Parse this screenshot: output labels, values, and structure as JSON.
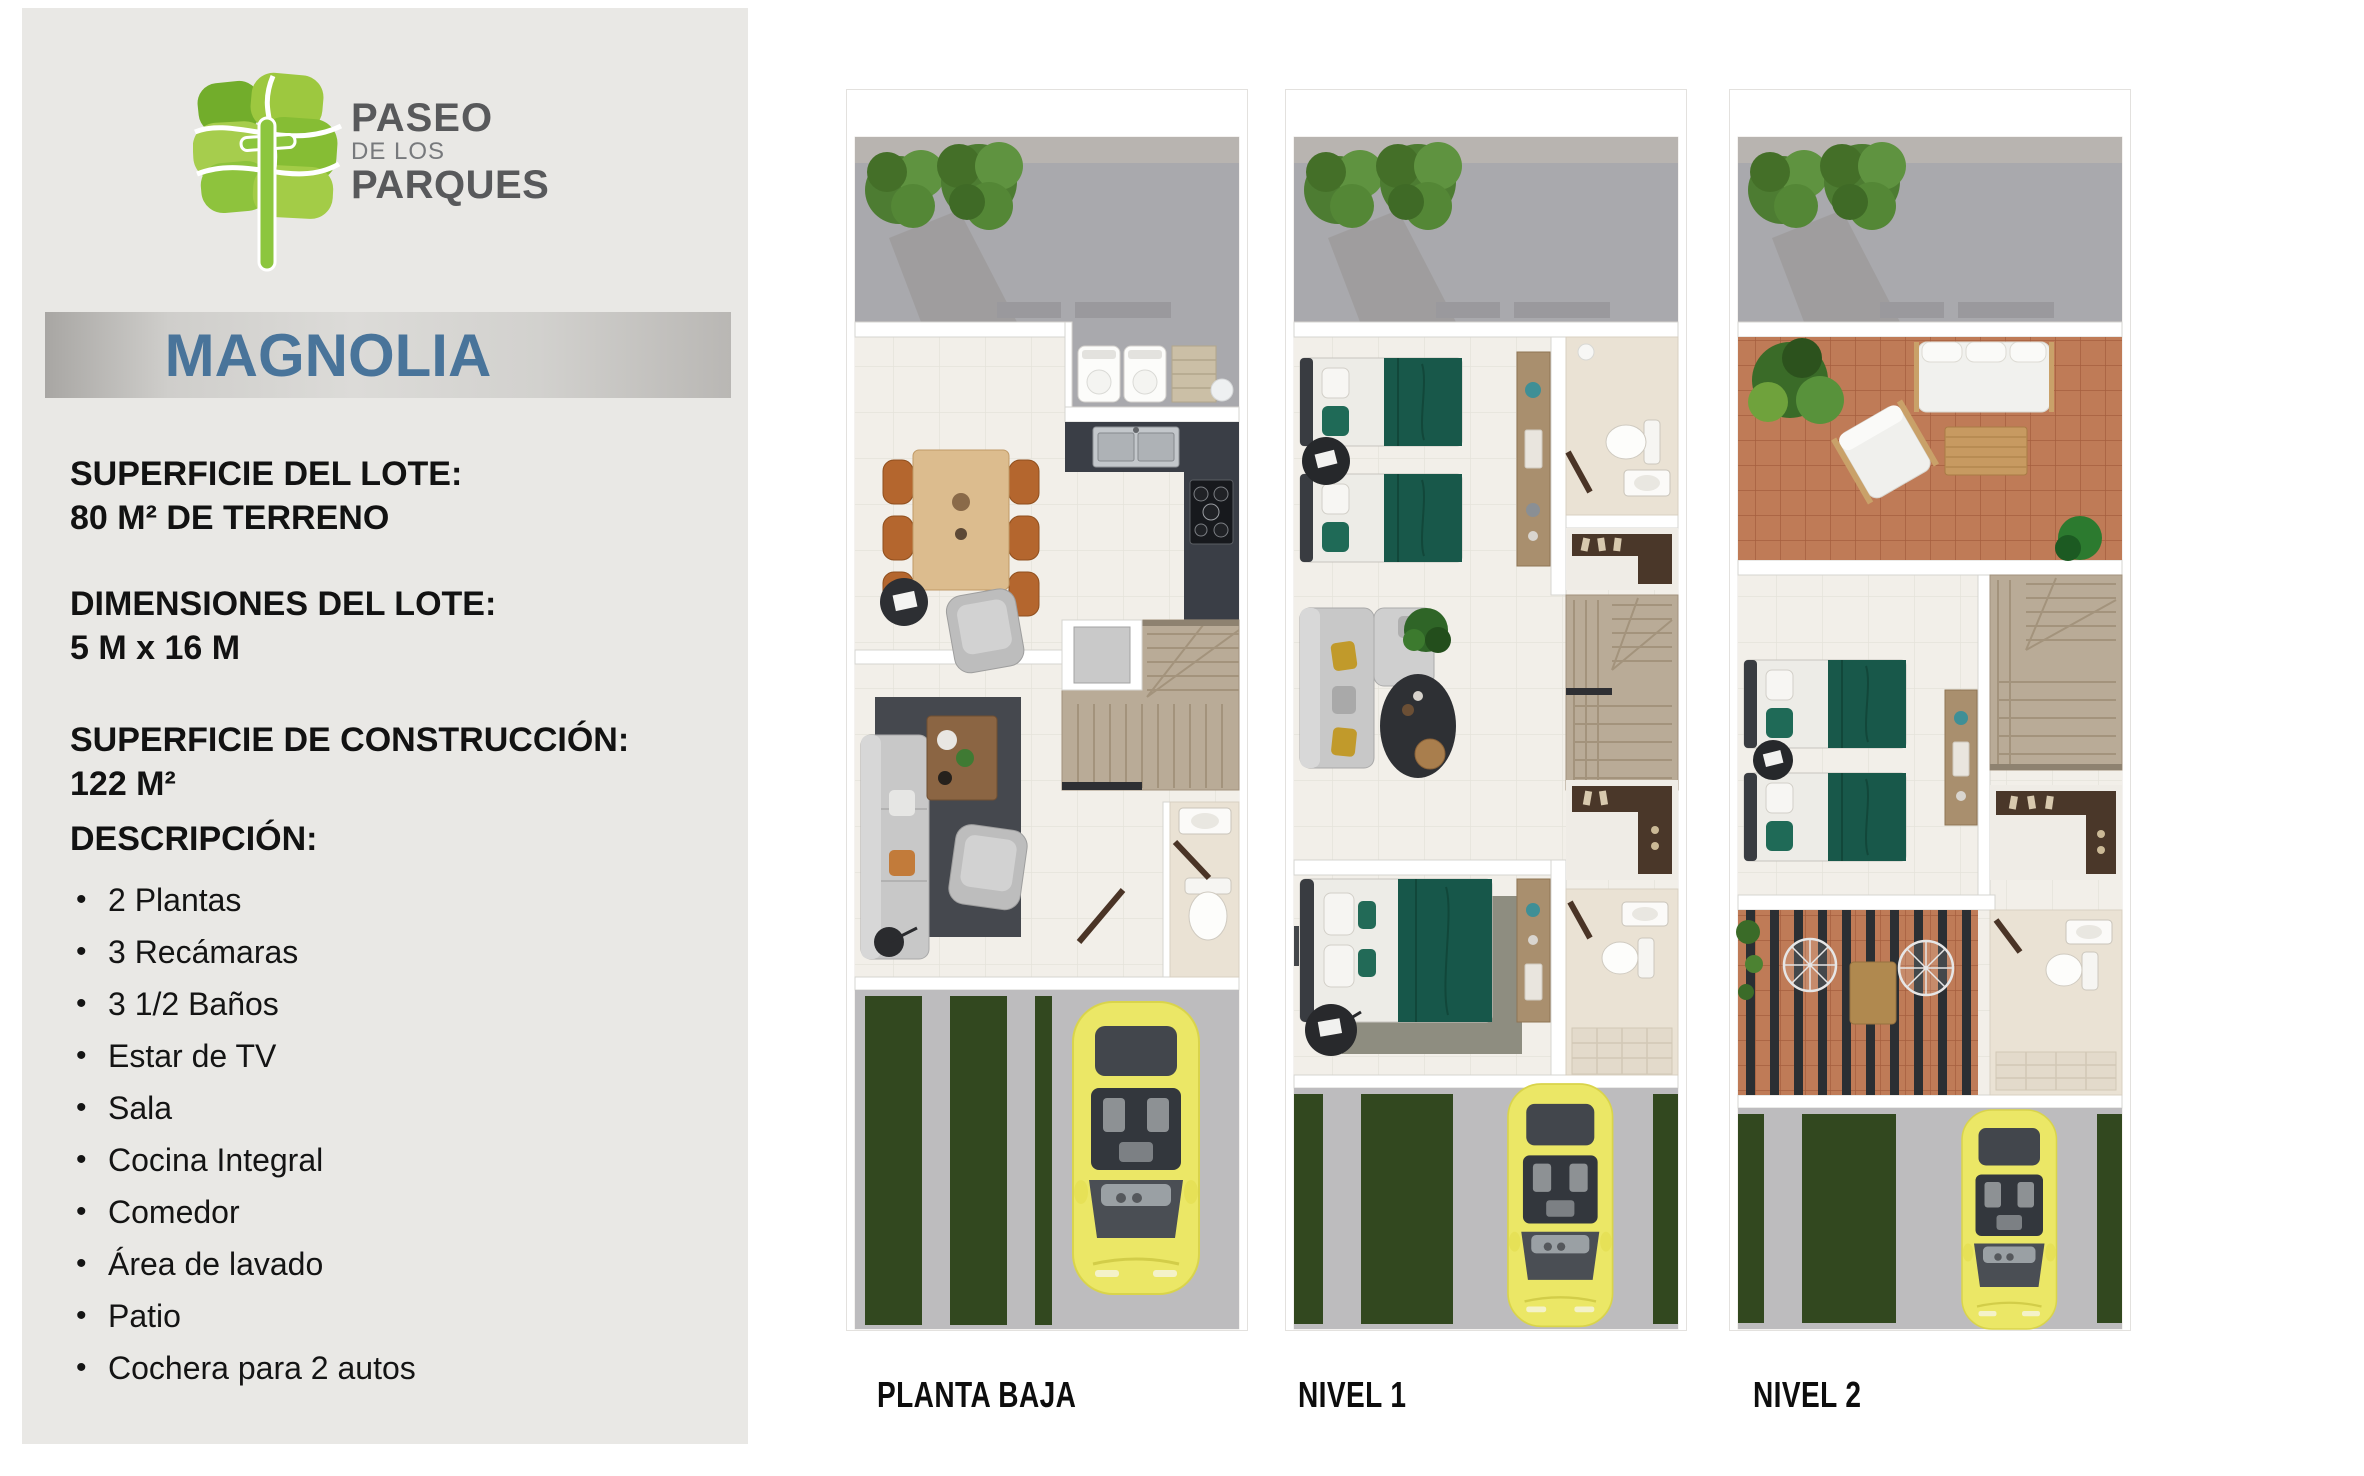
{
  "brand": {
    "name_line1": "PASEO",
    "name_line2": "DE LOS",
    "name_line3": "PARQUES"
  },
  "model": {
    "name": "MAGNOLIA"
  },
  "specs": [
    {
      "label": "SUPERFICIE DEL LOTE:",
      "value": "80 M² DE TERRENO"
    },
    {
      "label": "DIMENSIONES DEL LOTE:",
      "value": "5 M x 16 M"
    },
    {
      "label": "SUPERFICIE DE CONSTRUCCIÓN:",
      "value": "122 M²"
    }
  ],
  "description": {
    "heading": "DESCRIPCIÓN:",
    "items": [
      "2 Plantas",
      "3 Recámaras",
      "3 1/2 Baños",
      "Estar de TV",
      "Sala",
      "Cocina Integral",
      "Comedor",
      "Área de lavado",
      "Patio",
      "Cochera para 2 autos"
    ]
  },
  "floorplans": [
    {
      "label": "PLANTA BAJA"
    },
    {
      "label": "NIVEL 1"
    },
    {
      "label": "NIVEL 2"
    }
  ],
  "colors": {
    "panel_gray": "#e9e8e5",
    "title_blue": "#49749a",
    "logo_green_light": "#a6cd4d",
    "logo_green_dark": "#72ad2b",
    "logo_text_gray": "#58595b",
    "bed_green": "#18584a",
    "car_yellow": "#ebe766",
    "terracotta": "#bf7b57",
    "grass_green": "#32481f",
    "patio_gray": "#a9a9ad"
  }
}
